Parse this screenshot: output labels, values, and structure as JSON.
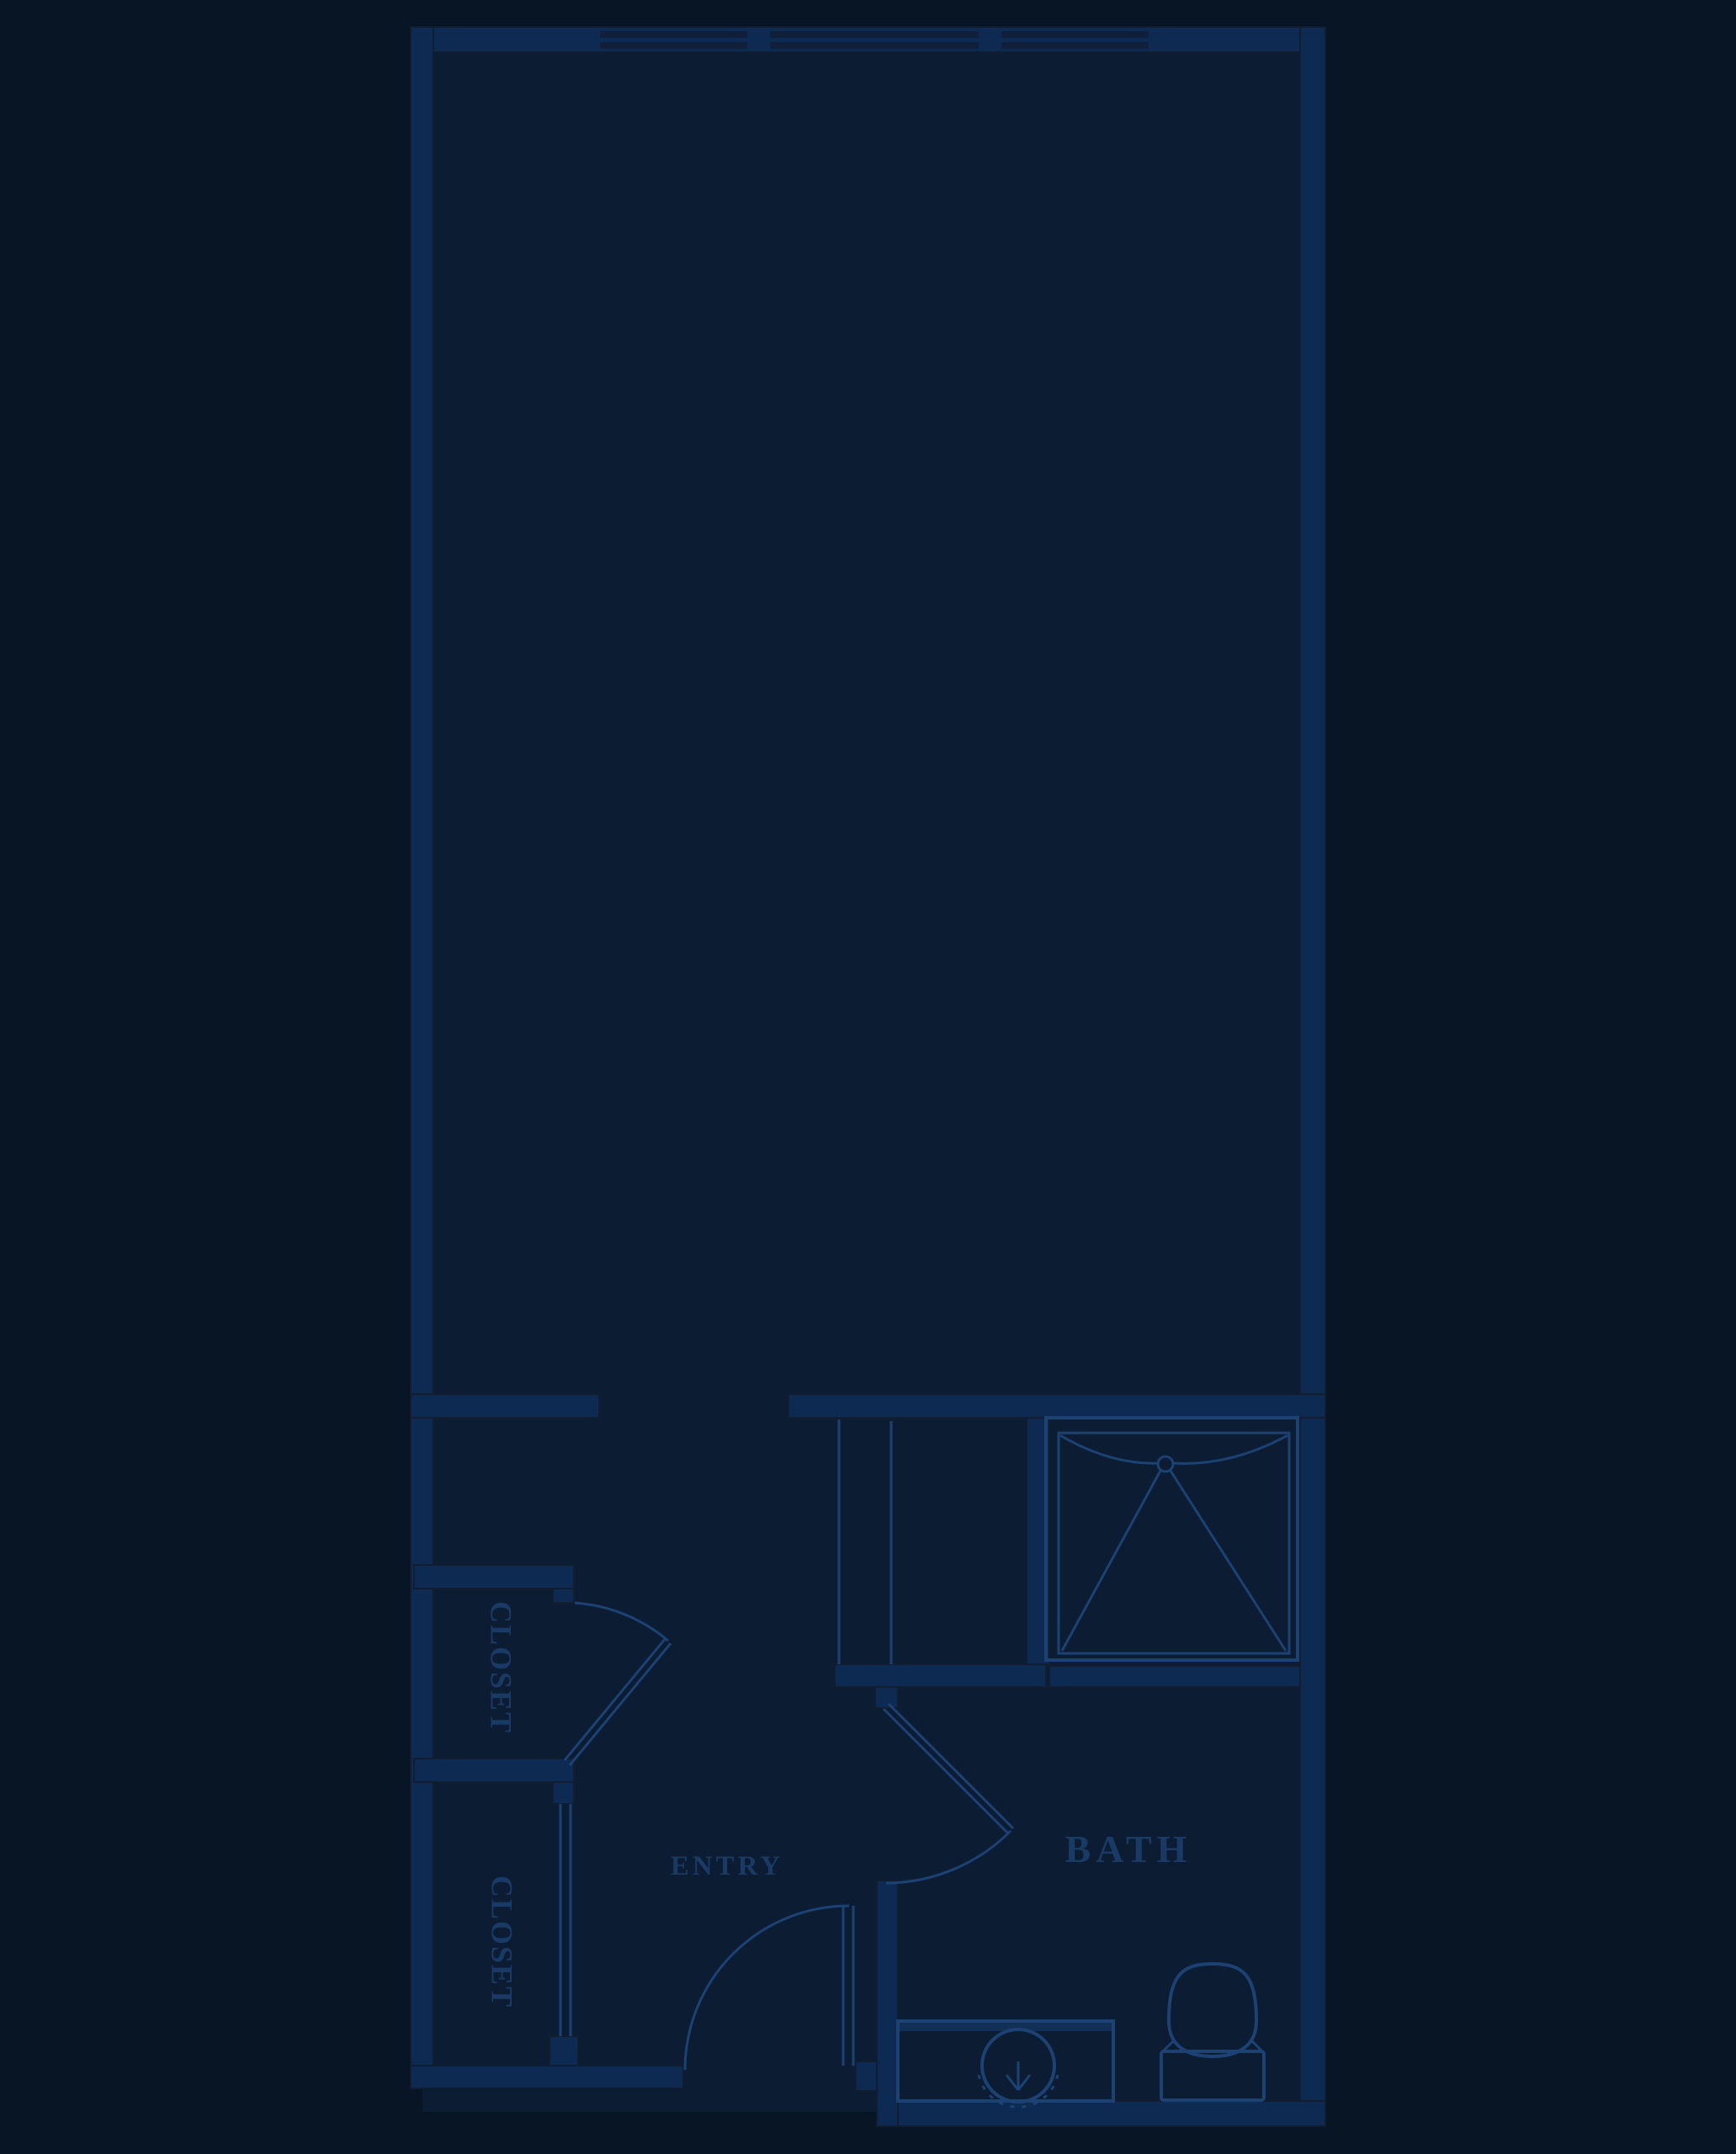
{
  "document": {
    "type": "floor-plan-blueprint",
    "style": "dark navy blueprint, single studio unit"
  },
  "palette": {
    "background": "#081525",
    "floor": "#0b1c33",
    "wall": "#0d2b52",
    "wall_edge": "#121d2f",
    "window_glass": "#101f3a",
    "line": "#1c4273",
    "text": "#1a3a66"
  },
  "labels": {
    "closet_upper": "CLOSET",
    "closet_lower": "CLOSET",
    "entry": "ENTRY",
    "bath": "BATH"
  },
  "fixtures": [
    {
      "name": "shower",
      "symbol": "square pan with drain and corner lines"
    },
    {
      "name": "sink-vanity",
      "symbol": "counter with round basin and faucet"
    },
    {
      "name": "toilet",
      "symbol": "tank and elongated bowl"
    },
    {
      "name": "windows",
      "count": 3,
      "location": "top wall"
    },
    {
      "name": "doors",
      "count": 3,
      "location": "closet, bath, entry (swing arcs)"
    }
  ]
}
